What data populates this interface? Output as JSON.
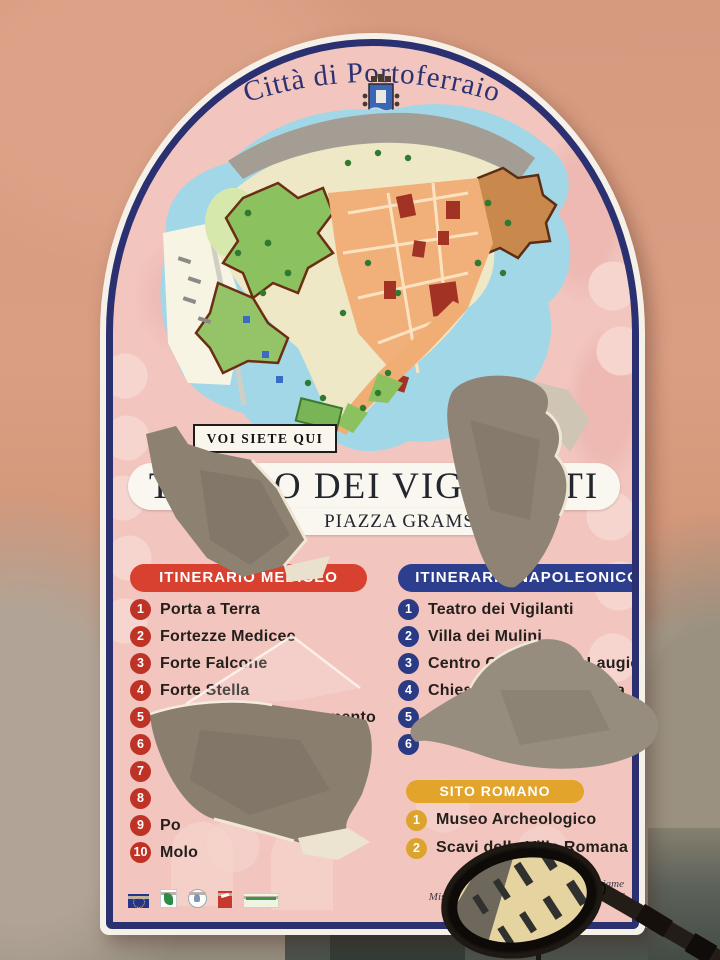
{
  "sign": {
    "city_title": "Città di Portoferraio",
    "you_are_here": "VOI SIETE QUI",
    "venue_name": "TEATRO DEI VIGILANTI",
    "venue_location": "PIAZZA GRAMSCI",
    "medici": {
      "header": "ITINERARIO MEDICEO",
      "accent_color": "#d8402f",
      "items": [
        {
          "num": "1",
          "label": "Porta a Terra"
        },
        {
          "num": "2",
          "label": "Fortezze Medicee"
        },
        {
          "num": "3",
          "label": "Forte Falcone"
        },
        {
          "num": "4",
          "label": "Forte Stella"
        },
        {
          "num": "5",
          "label": "Chiesa del S.S. Sacramento"
        },
        {
          "num": "6",
          "label": ""
        },
        {
          "num": "7",
          "label": ""
        },
        {
          "num": "8",
          "label": ""
        },
        {
          "num": "9",
          "label": "Po"
        },
        {
          "num": "10",
          "label": "Molo"
        }
      ]
    },
    "napoleonic": {
      "header": "ITINERARIO NAPOLEONICO",
      "accent_color": "#2c3e8d",
      "items": [
        {
          "num": "1",
          "label": "Teatro dei Vigilanti"
        },
        {
          "num": "2",
          "label": "Villa dei Mulini"
        },
        {
          "num": "3",
          "label": "Centro Culturale De Laugier"
        },
        {
          "num": "4",
          "label": "Chiesa della Misericordia"
        },
        {
          "num": "5",
          "label": ""
        },
        {
          "num": "6",
          "label": ""
        }
      ]
    },
    "roman": {
      "header": "SITO ROMANO",
      "accent_color": "#e3a42c",
      "items": [
        {
          "num": "1",
          "label": "Museo Archeologico"
        },
        {
          "num": "2",
          "label": "Scavi della Villa Romana"
        }
      ]
    },
    "footer": {
      "credit_line1": "Opera realizzata con il cofinanziame",
      "credit_line2": "Misura 313 aA \"INCENTIVAZIONE DI ATT",
      "logos": [
        "eu-flag-logo",
        "regione-logo",
        "repubblica-italiana-logo",
        "provincia-logo",
        "leader-plus-logo"
      ]
    },
    "colors": {
      "border_navy": "#2b3070",
      "panel_pink": "#f2c5bf",
      "map_water": "#a2d7e8",
      "torn_backing_gray": "#8d8172"
    }
  },
  "photo": {
    "objects": [
      "plaster-wall",
      "torn-paper-holes",
      "motorcycle-mirror"
    ]
  }
}
